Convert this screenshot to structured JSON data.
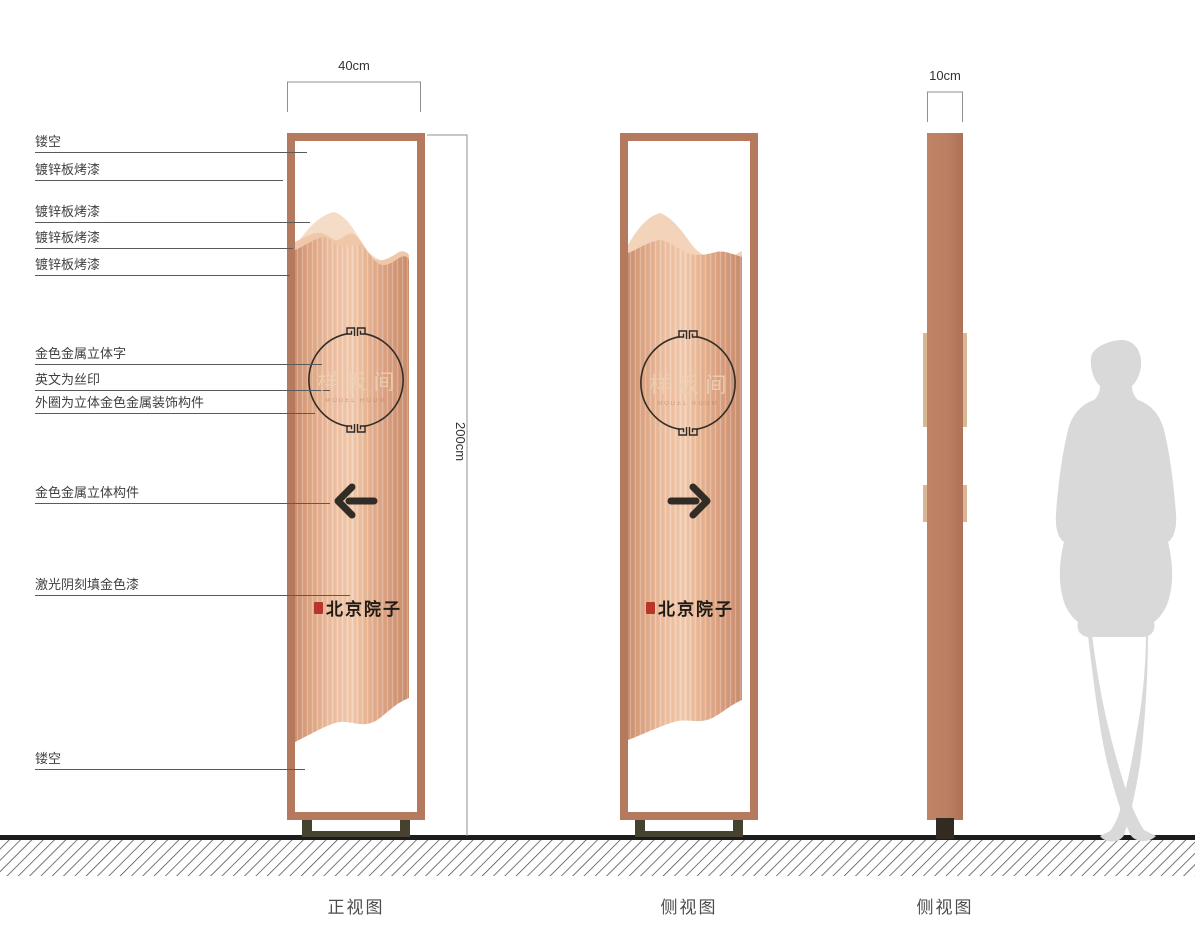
{
  "annotations": [
    {
      "text": "镂空"
    },
    {
      "text": "镀锌板烤漆"
    },
    {
      "text": "镀锌板烤漆"
    },
    {
      "text": "镀锌板烤漆"
    },
    {
      "text": "镀锌板烤漆"
    },
    {
      "text": "金色金属立体字"
    },
    {
      "text": "英文为丝印"
    },
    {
      "text": "外圈为立体金色金属装饰构件"
    },
    {
      "text": "金色金属立体构件"
    },
    {
      "text": "激光阴刻填金色漆"
    },
    {
      "text": "镂空"
    }
  ],
  "dimensions": {
    "front_width": "40cm",
    "height": "200cm",
    "side_width": "10cm"
  },
  "sign": {
    "room_name": "样板间",
    "room_name_en": "MODEL ROOM",
    "brand_name": "北京院子"
  },
  "views": {
    "front": "正视图",
    "side": "侧视图",
    "side_profile": "侧视图"
  },
  "colors": {
    "frame": "#b57a5e",
    "body_highlight": "#f3cdb2",
    "body_shadow": "#cd9274",
    "mountain_back": "#f5dcc7",
    "mountain_mid": "#efc8aa",
    "base_stand": "#47412f",
    "seal_red": "#b5372a",
    "ink": "#2e2a26",
    "silhouette_gray": "#d9d9d9"
  }
}
